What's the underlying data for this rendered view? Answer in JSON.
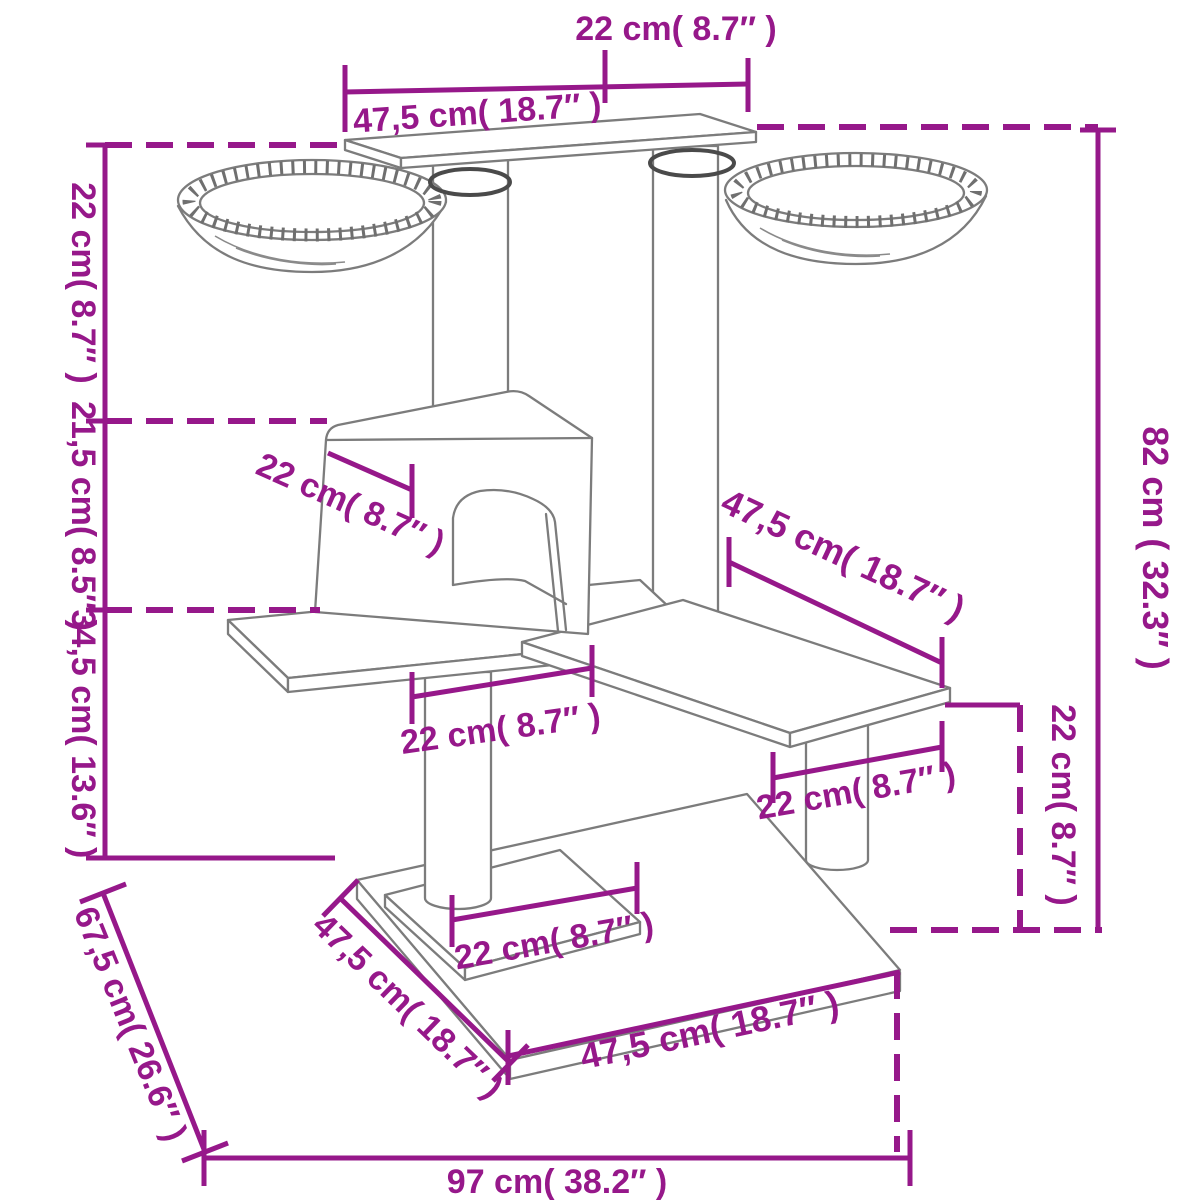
{
  "diagram": {
    "accent_color": "#96188A",
    "line_color": "#7c7c7c",
    "labels": {
      "top_overhang": "22 cm( 8.7″ )",
      "top_platform_width": "47,5 cm( 18.7″ )",
      "height_top_section": "22 cm( 8.7″ )",
      "height_mid_section": "21,5 cm( 8.5″ )",
      "height_lower_section": "34,5 cm( 13.6″ )",
      "base_depth_diagonal": "67,5 cm( 26.6″ )",
      "total_height": "82 cm ( 32.3″ )",
      "step_height": "22 cm( 8.7″ )",
      "house_roof_depth": "22 cm( 8.7″ )",
      "mid_platform_length": "47,5 cm( 18.7″ )",
      "under_house_span": "22 cm( 8.7″ )",
      "step_platform_span": "22 cm( 8.7″ )",
      "base_platform_span": "22 cm( 8.7″ )",
      "base_left_edge": "47,5 cm( 18.7″ )",
      "base_front_edge": "47,5 cm( 18.7″ )",
      "base_width": "97 cm( 38.2″ )"
    }
  }
}
